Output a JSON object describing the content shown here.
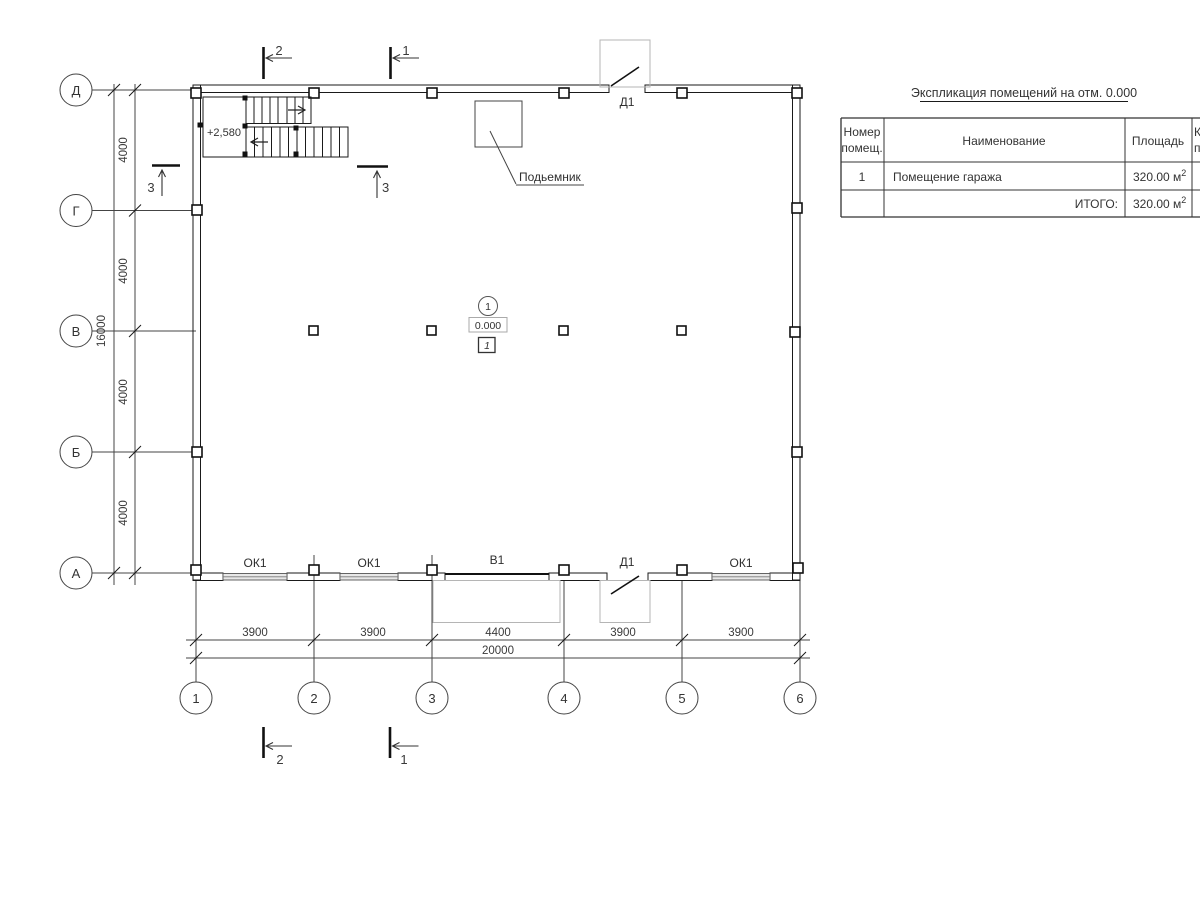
{
  "axes": {
    "rows": [
      "Д",
      "Г",
      "В",
      "Б",
      "А"
    ],
    "cols": [
      "1",
      "2",
      "3",
      "4",
      "5",
      "6"
    ]
  },
  "dims": {
    "row_segments": [
      "4000",
      "4000",
      "4000",
      "4000"
    ],
    "row_total": "16000",
    "col_segments": [
      "3900",
      "3900",
      "4400",
      "3900",
      "3900"
    ],
    "col_total": "20000"
  },
  "sections": {
    "s1": "1",
    "s2": "2",
    "s3": "3"
  },
  "openings": {
    "window": "ОК1",
    "gate": "В1",
    "door": "Д1"
  },
  "stairs": {
    "level": "+2,580"
  },
  "hoist": {
    "label": "Подьемник"
  },
  "marker": {
    "room_number": "1",
    "elevation": "0.000",
    "finish_type": "1"
  },
  "table": {
    "title": "Экспликация помещений на отм. 0.000",
    "headers": {
      "col1_line1": "Номер",
      "col1_line2": "помещ.",
      "col2": "Наименование",
      "col3": "Площадь",
      "col4_line1": "К",
      "col4_line2": "п"
    },
    "row": {
      "num": "1",
      "name": "Помещение гаража",
      "area": "320.00 м",
      "area_sup": "2"
    },
    "total_label": "ИТОГО:",
    "total": {
      "area": "320.00 м",
      "area_sup": "2"
    }
  }
}
